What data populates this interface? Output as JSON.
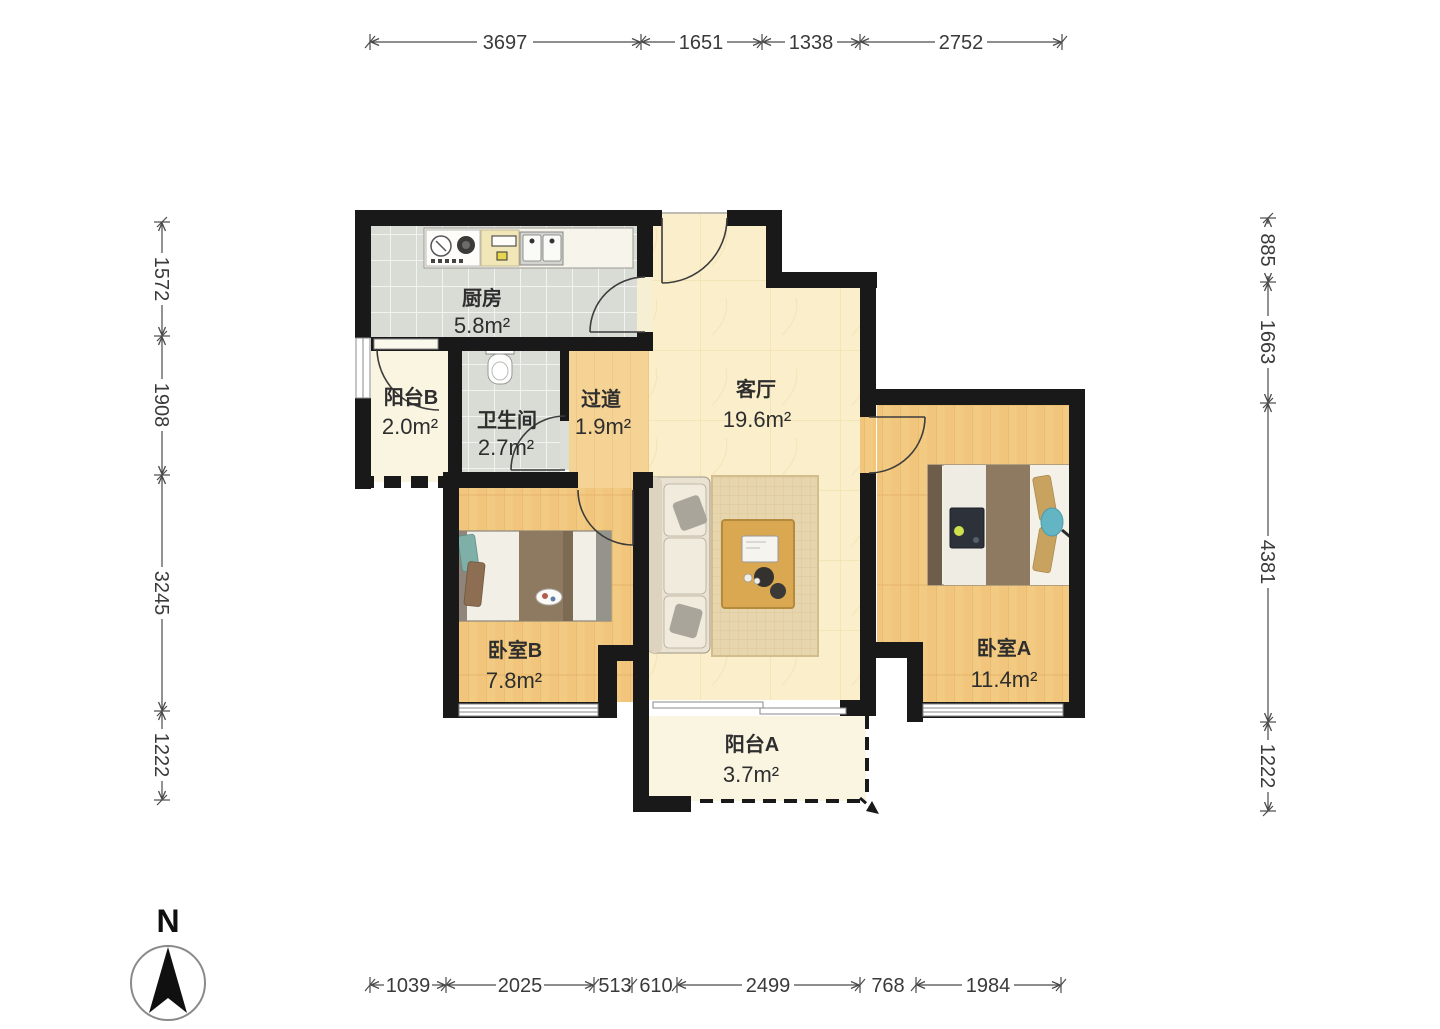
{
  "dims": {
    "top": [
      "3697",
      "1651",
      "1338",
      "2752"
    ],
    "bottom": [
      "1039",
      "2025",
      "513",
      "610",
      "2499",
      "768",
      "1984"
    ],
    "left": [
      "1572",
      "1908",
      "3245",
      "1222"
    ],
    "right": [
      "885",
      "1663",
      "4381",
      "1222"
    ]
  },
  "rooms": {
    "kitchen": {
      "name": "厨房",
      "area": "5.8m²"
    },
    "balcony_b": {
      "name": "阳台B",
      "area": "2.0m²"
    },
    "bathroom": {
      "name": "卫生间",
      "area": "2.7m²"
    },
    "hallway": {
      "name": "过道",
      "area": "1.9m²"
    },
    "living": {
      "name": "客厅",
      "area": "19.6m²"
    },
    "bedroom_b": {
      "name": "卧室B",
      "area": "7.8m²"
    },
    "bedroom_a": {
      "name": "卧室A",
      "area": "11.4m²"
    },
    "balcony_a": {
      "name": "阳台A",
      "area": "3.7m²"
    }
  },
  "compass": {
    "label": "N"
  },
  "colors": {
    "wall": "#191919",
    "wood_floor": "#f3ca81",
    "hall_floor": "#f5d395",
    "tile_floor": "#d9dcd5",
    "living_floor": "#faeecb",
    "balcony_floor": "#f9f5e1",
    "accent_teal": "#64b5c4",
    "blanket_brown": "#8d7a61"
  }
}
